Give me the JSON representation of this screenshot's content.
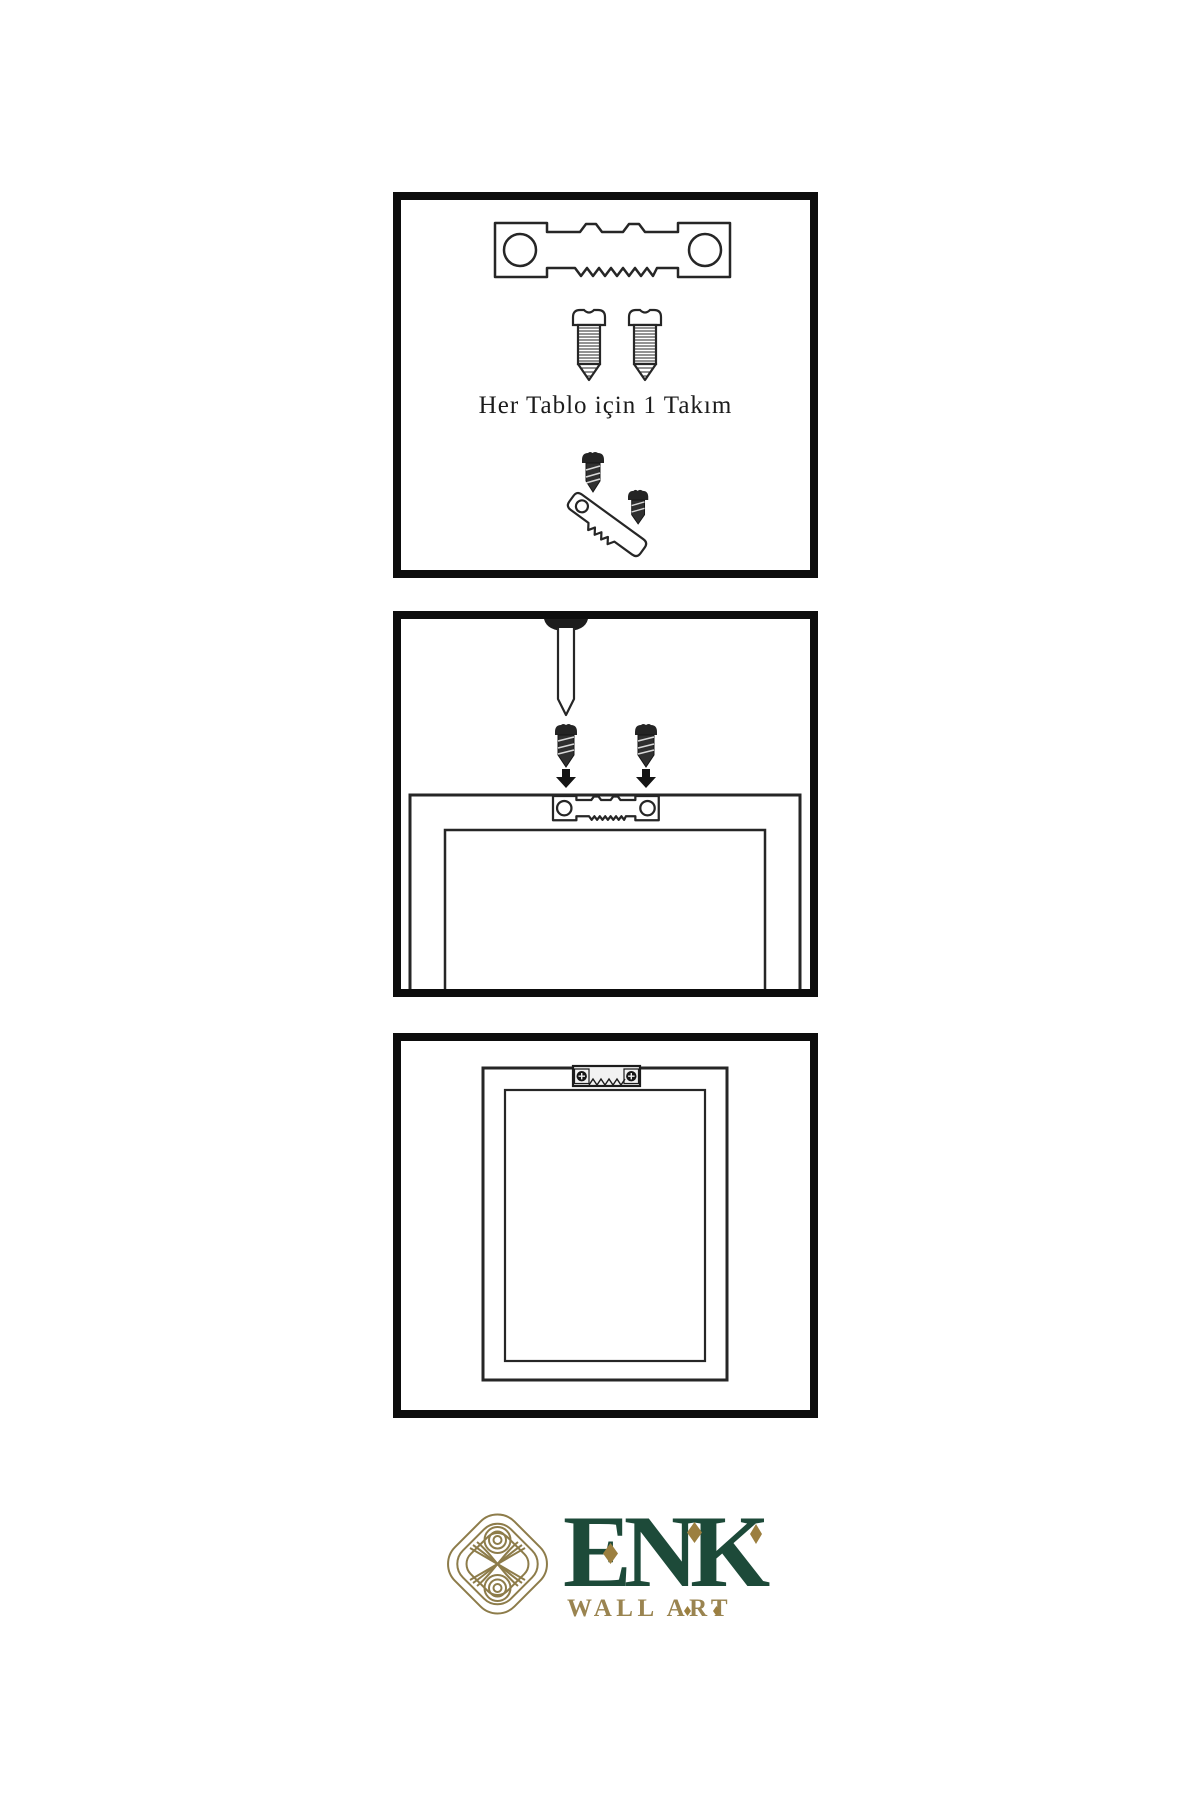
{
  "page": {
    "width_px": 1200,
    "height_px": 1800,
    "background": "#ffffff"
  },
  "instruction_panels": {
    "panel_1": {
      "caption": "Her Tablo için 1 Takım",
      "icons": [
        "sawtooth-hanger-icon",
        "screw-icon",
        "screw-icon",
        "screw-into-hanger-icon"
      ]
    },
    "panel_2": {
      "icons": [
        "wall-nail-icon",
        "screw-icon",
        "screw-icon",
        "down-arrow-icon",
        "down-arrow-icon",
        "frame-back-with-hanger-icon"
      ]
    },
    "panel_3": {
      "icons": [
        "hanging-frame-with-hanger-icon"
      ]
    }
  },
  "logo": {
    "brand": "ENK",
    "tagline": "WALL ART",
    "icon": "interlocking-knot-icon",
    "colors": {
      "brand_green": "#1d4a39",
      "gold": "#9c7f3f",
      "knot_gold": "#8d7c4a"
    }
  },
  "line_art": {
    "stroke": "#262626",
    "panel_border": "#0d0d0d"
  }
}
